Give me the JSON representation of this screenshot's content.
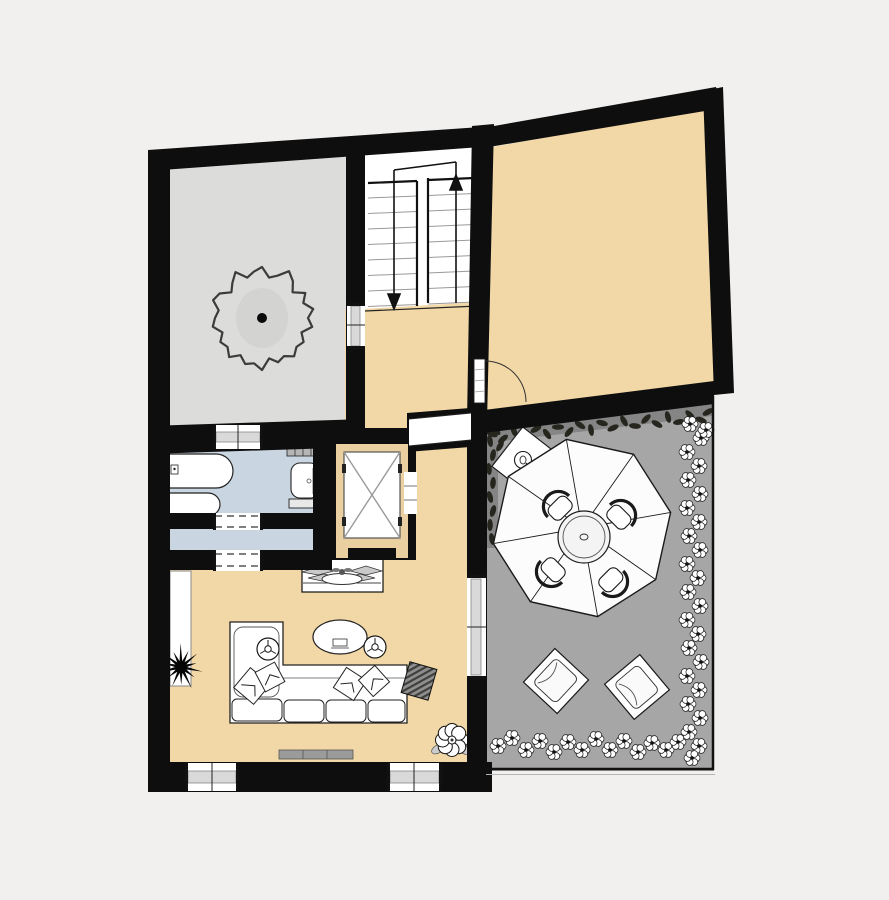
{
  "canvas": {
    "width": 889,
    "height": 900
  },
  "colors": {
    "background": "#f1f0ee",
    "wall": "#0e0e0e",
    "room_gray": "#dcdcda",
    "room_tan": "#f2d8a6",
    "bathroom_blue": "#c9d6e2",
    "terrace_gray": "#a6a6a6",
    "elevator_frame_tan": "#eacfa0",
    "stair_white": "#ffffff",
    "vine_gray": "#858585",
    "hedge_blob": "#474747",
    "glazing_gray": "#d9d9d9",
    "line_dark": "#1a1a1a"
  },
  "floor_plan": {
    "type": "architectural-floor-plan",
    "rooms": [
      {
        "id": "room-top-left",
        "kind": "room",
        "fill": "room_gray",
        "symbols": [
          "tree"
        ]
      },
      {
        "id": "staircase",
        "kind": "stairwell",
        "fill": "stair_white",
        "symbols": [
          "two-flights",
          "down-arrow",
          "up-arrow"
        ]
      },
      {
        "id": "room-top-right",
        "kind": "room",
        "fill": "room_tan",
        "symbols": [
          "swing-door"
        ]
      },
      {
        "id": "hallway",
        "kind": "hall",
        "fill": "room_tan"
      },
      {
        "id": "bathroom",
        "kind": "bathroom",
        "fill": "bathroom_blue",
        "symbols": [
          "bathtub",
          "shower-tub",
          "toilet",
          "radiator"
        ]
      },
      {
        "id": "vestibule",
        "kind": "hall",
        "fill": "bathroom_blue",
        "symbols": [
          "dashed-opening",
          "dashed-opening"
        ]
      },
      {
        "id": "elevator",
        "kind": "elevator",
        "symbols": [
          "crossed-shaft",
          "elevator-door"
        ]
      },
      {
        "id": "living-room",
        "kind": "room",
        "fill": "room_tan",
        "symbols": [
          "corner-sofa",
          "pillows",
          "coffee-table",
          "side-table",
          "side-table",
          "sideboard",
          "planter",
          "wardrobe",
          "rug",
          "radiator",
          "flower"
        ]
      },
      {
        "id": "terrace",
        "kind": "terrace",
        "fill": "terrace_gray",
        "symbols": [
          "parasol",
          "dining-table",
          "chairs-4",
          "umbrella-base",
          "lounger",
          "lounger",
          "flower-hedge",
          "vine-border"
        ]
      }
    ],
    "openings": {
      "windows": 5,
      "doors": [
        "swing-door-top-right",
        "elevator-door",
        "dashed-opening-bathroom",
        "dashed-opening-living",
        "wide-opening-hallway"
      ]
    }
  }
}
